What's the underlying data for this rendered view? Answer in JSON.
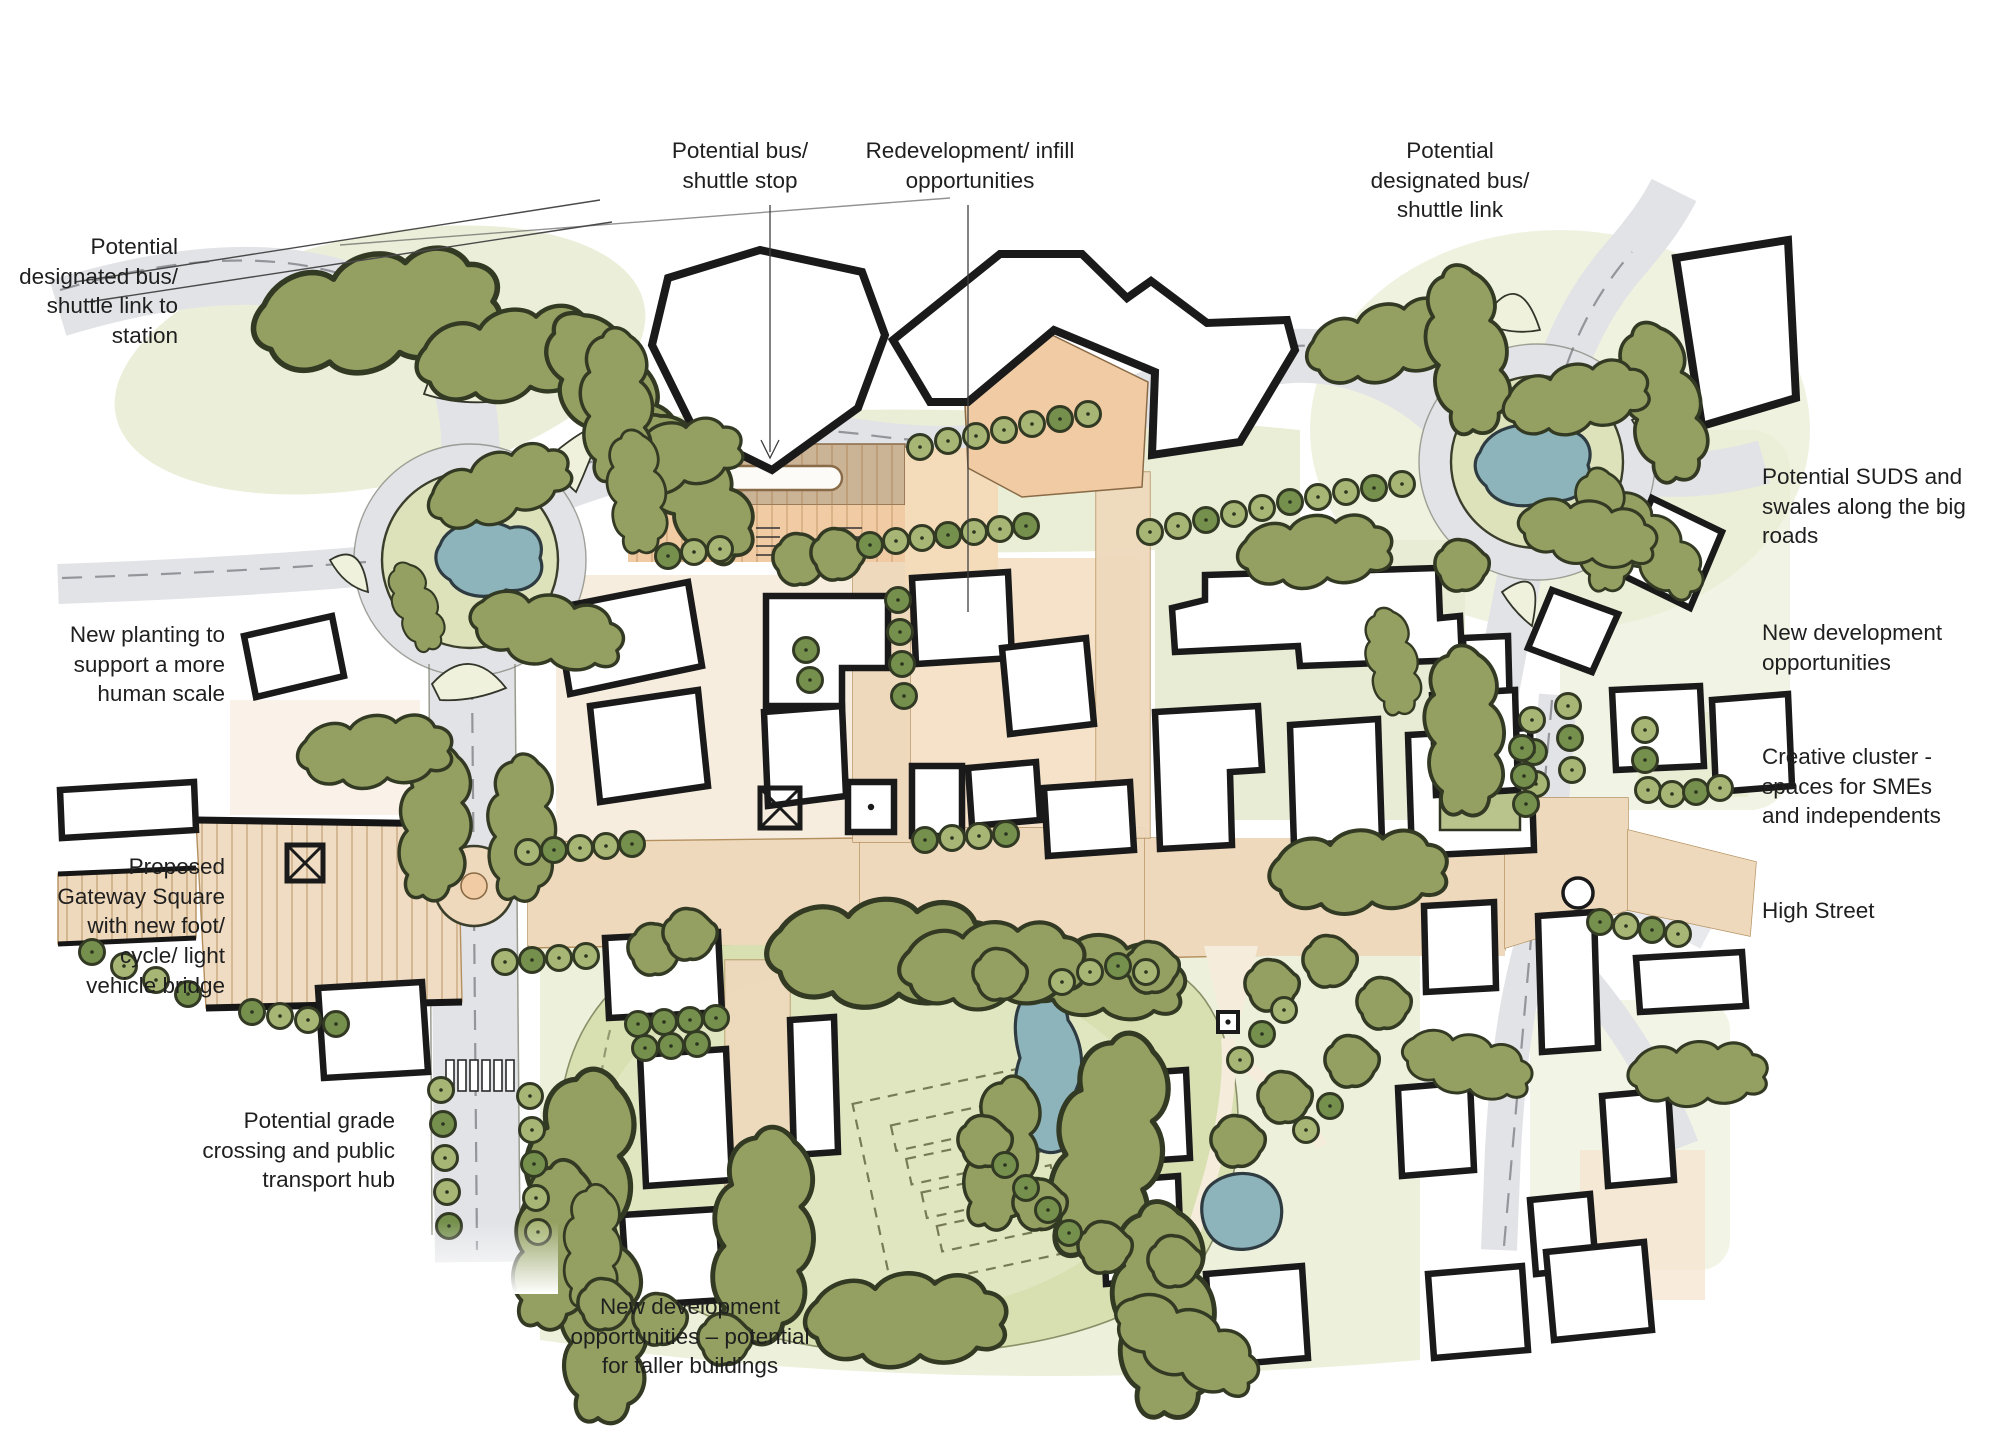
{
  "annotations": {
    "bus_link_station": {
      "text": "Potential\ndesignated bus/\nshuttle link to\nstation"
    },
    "bus_stop": {
      "text": "Potential bus/\nshuttle stop"
    },
    "redevelopment": {
      "text": "Redevelopment/ infill\nopportunities"
    },
    "bus_link": {
      "text": "Potential\ndesignated bus/\nshuttle link"
    },
    "suds": {
      "text": "Potential SUDS and\nswales along the big\nroads"
    },
    "new_dev": {
      "text": "New development\nopportunities"
    },
    "creative": {
      "text": "Creative cluster -\nspaces for SMEs\nand  independents"
    },
    "high_street": {
      "text": "High Street"
    },
    "planting": {
      "text": "New planting to\nsupport a more\nhuman scale"
    },
    "gateway": {
      "text": "Proposed\nGateway Square\nwith new foot/\ncycle/ light\nvehicle bridge"
    },
    "grade_crossing": {
      "text": "Potential grade\ncrossing and public\ntransport hub"
    },
    "taller": {
      "text": "New development\nopportunities – potential\nfor taller buildings"
    }
  },
  "colors": {
    "road": "#e2e3e7",
    "road_line": "#85878c",
    "paving": "#eed9bc",
    "paving_deep": "#dec39b",
    "paving_line": "#a9824f",
    "plaza": "#f0dcc2",
    "peach": "#f0cba4",
    "peach_soft": "#f6e3cc",
    "building": "#ffffff",
    "outline": "#1a1a1a",
    "tree": "#94a061",
    "tree_dark": "#75904d",
    "tree_light": "#a7b575",
    "tree_edge": "#333a24",
    "pale_green": "#e8ecd2",
    "field": "#d8e0b2",
    "field_light": "#e4e9c6",
    "pond": "#8cb4ba",
    "pond_edge": "#2e3c42",
    "ink": "#1f1f1f",
    "cream": "#f6ecdb"
  }
}
